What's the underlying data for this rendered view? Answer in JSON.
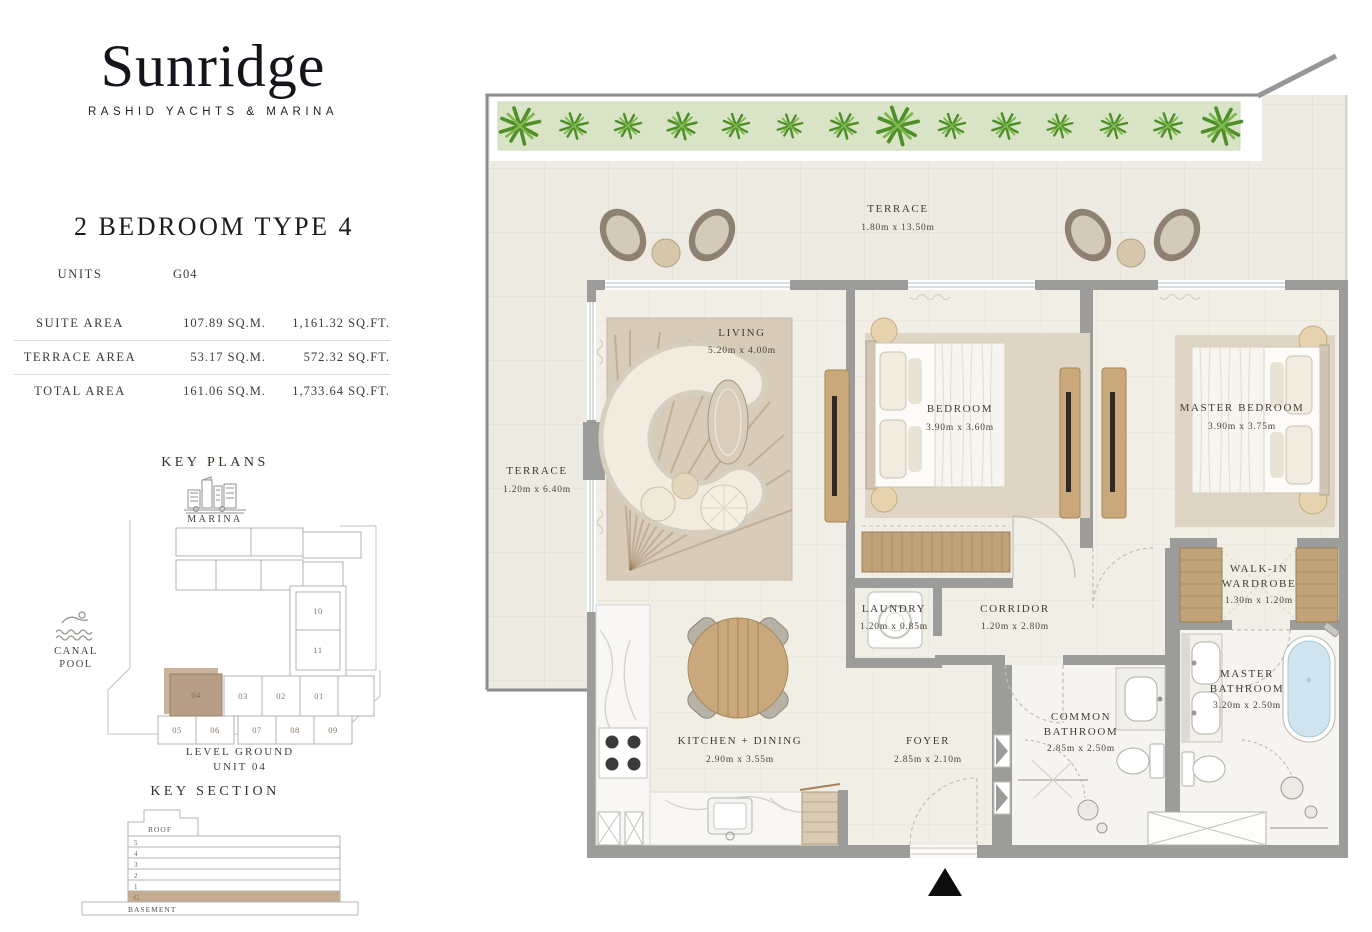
{
  "brand": {
    "name": "Sunridge",
    "tagline": "RASHID YACHTS & MARINA"
  },
  "unit": {
    "title": "2 BEDROOM TYPE 4"
  },
  "table": {
    "units_label": "UNITS",
    "units_value": "G04",
    "rows": [
      {
        "label": "SUITE AREA",
        "sqm": "107.89 SQ.M.",
        "sqft": "1,161.32 SQ.FT."
      },
      {
        "label": "TERRACE AREA",
        "sqm": "53.17 SQ.M.",
        "sqft": "572.32 SQ.FT."
      },
      {
        "label": "TOTAL AREA",
        "sqm": "161.06 SQ.M.",
        "sqft": "1,733.64 SQ.FT."
      }
    ]
  },
  "key_plans": {
    "heading": "KEY PLANS",
    "marina": "MARINA",
    "canal_pool": "CANAL POOL",
    "caption1": "LEVEL GROUND",
    "caption2": "UNIT 04",
    "tower_units": [
      "10",
      "11"
    ],
    "row_units": [
      "04",
      "03",
      "02",
      "01"
    ],
    "bottom_units": [
      "05",
      "06",
      "07",
      "08",
      "09"
    ],
    "highlighted_unit": "04"
  },
  "key_section": {
    "heading": "KEY SECTION",
    "roof": "ROOF",
    "floors": [
      "5",
      "4",
      "3",
      "2",
      "1",
      "G"
    ],
    "highlighted_floor": "G",
    "basement": "BASEMENT"
  },
  "plan": {
    "terrace_top": {
      "l1": "TERRACE",
      "dims": "1.80m x 13.50m"
    },
    "terrace_left": {
      "l1": "TERRACE",
      "dims": "1.20m x 6.40m"
    },
    "living": {
      "l1": "LIVING",
      "dims": "5.20m x 4.00m"
    },
    "bedroom": {
      "l1": "BEDROOM",
      "dims": "3.90m x 3.60m"
    },
    "master_bedroom": {
      "l1": "MASTER BEDROOM",
      "dims": "3.90m x 3.75m"
    },
    "walk_in": {
      "l1": "WALK-IN",
      "l2": "WARDROBE",
      "dims": "1.30m x 1.20m"
    },
    "laundry": {
      "l1": "LAUNDRY",
      "dims": "1.20m x 0.85m"
    },
    "corridor": {
      "l1": "CORRIDOR",
      "dims": "1.20m x 2.80m"
    },
    "kitchen": {
      "l1": "KITCHEN + DINING",
      "dims": "2.90m x 3.55m"
    },
    "foyer": {
      "l1": "FOYER",
      "dims": "2.85m x 2.10m"
    },
    "common_bath": {
      "l1": "COMMON",
      "l2": "BATHROOM",
      "dims": "2.85m x 2.50m"
    },
    "master_bath": {
      "l1": "MASTER",
      "l2": "BATHROOM",
      "dims": "3.20m x 2.50m"
    }
  },
  "colors": {
    "wall": "#9c9c9a",
    "floor": "#f1eee6",
    "terrace_floor": "#edeae1",
    "planter": "#d9e3c6",
    "plant_green": "#4e8f28",
    "highlight_tan": "#b79d85",
    "wood": "#c9a87b",
    "tub_water": "#cfe4ee"
  }
}
